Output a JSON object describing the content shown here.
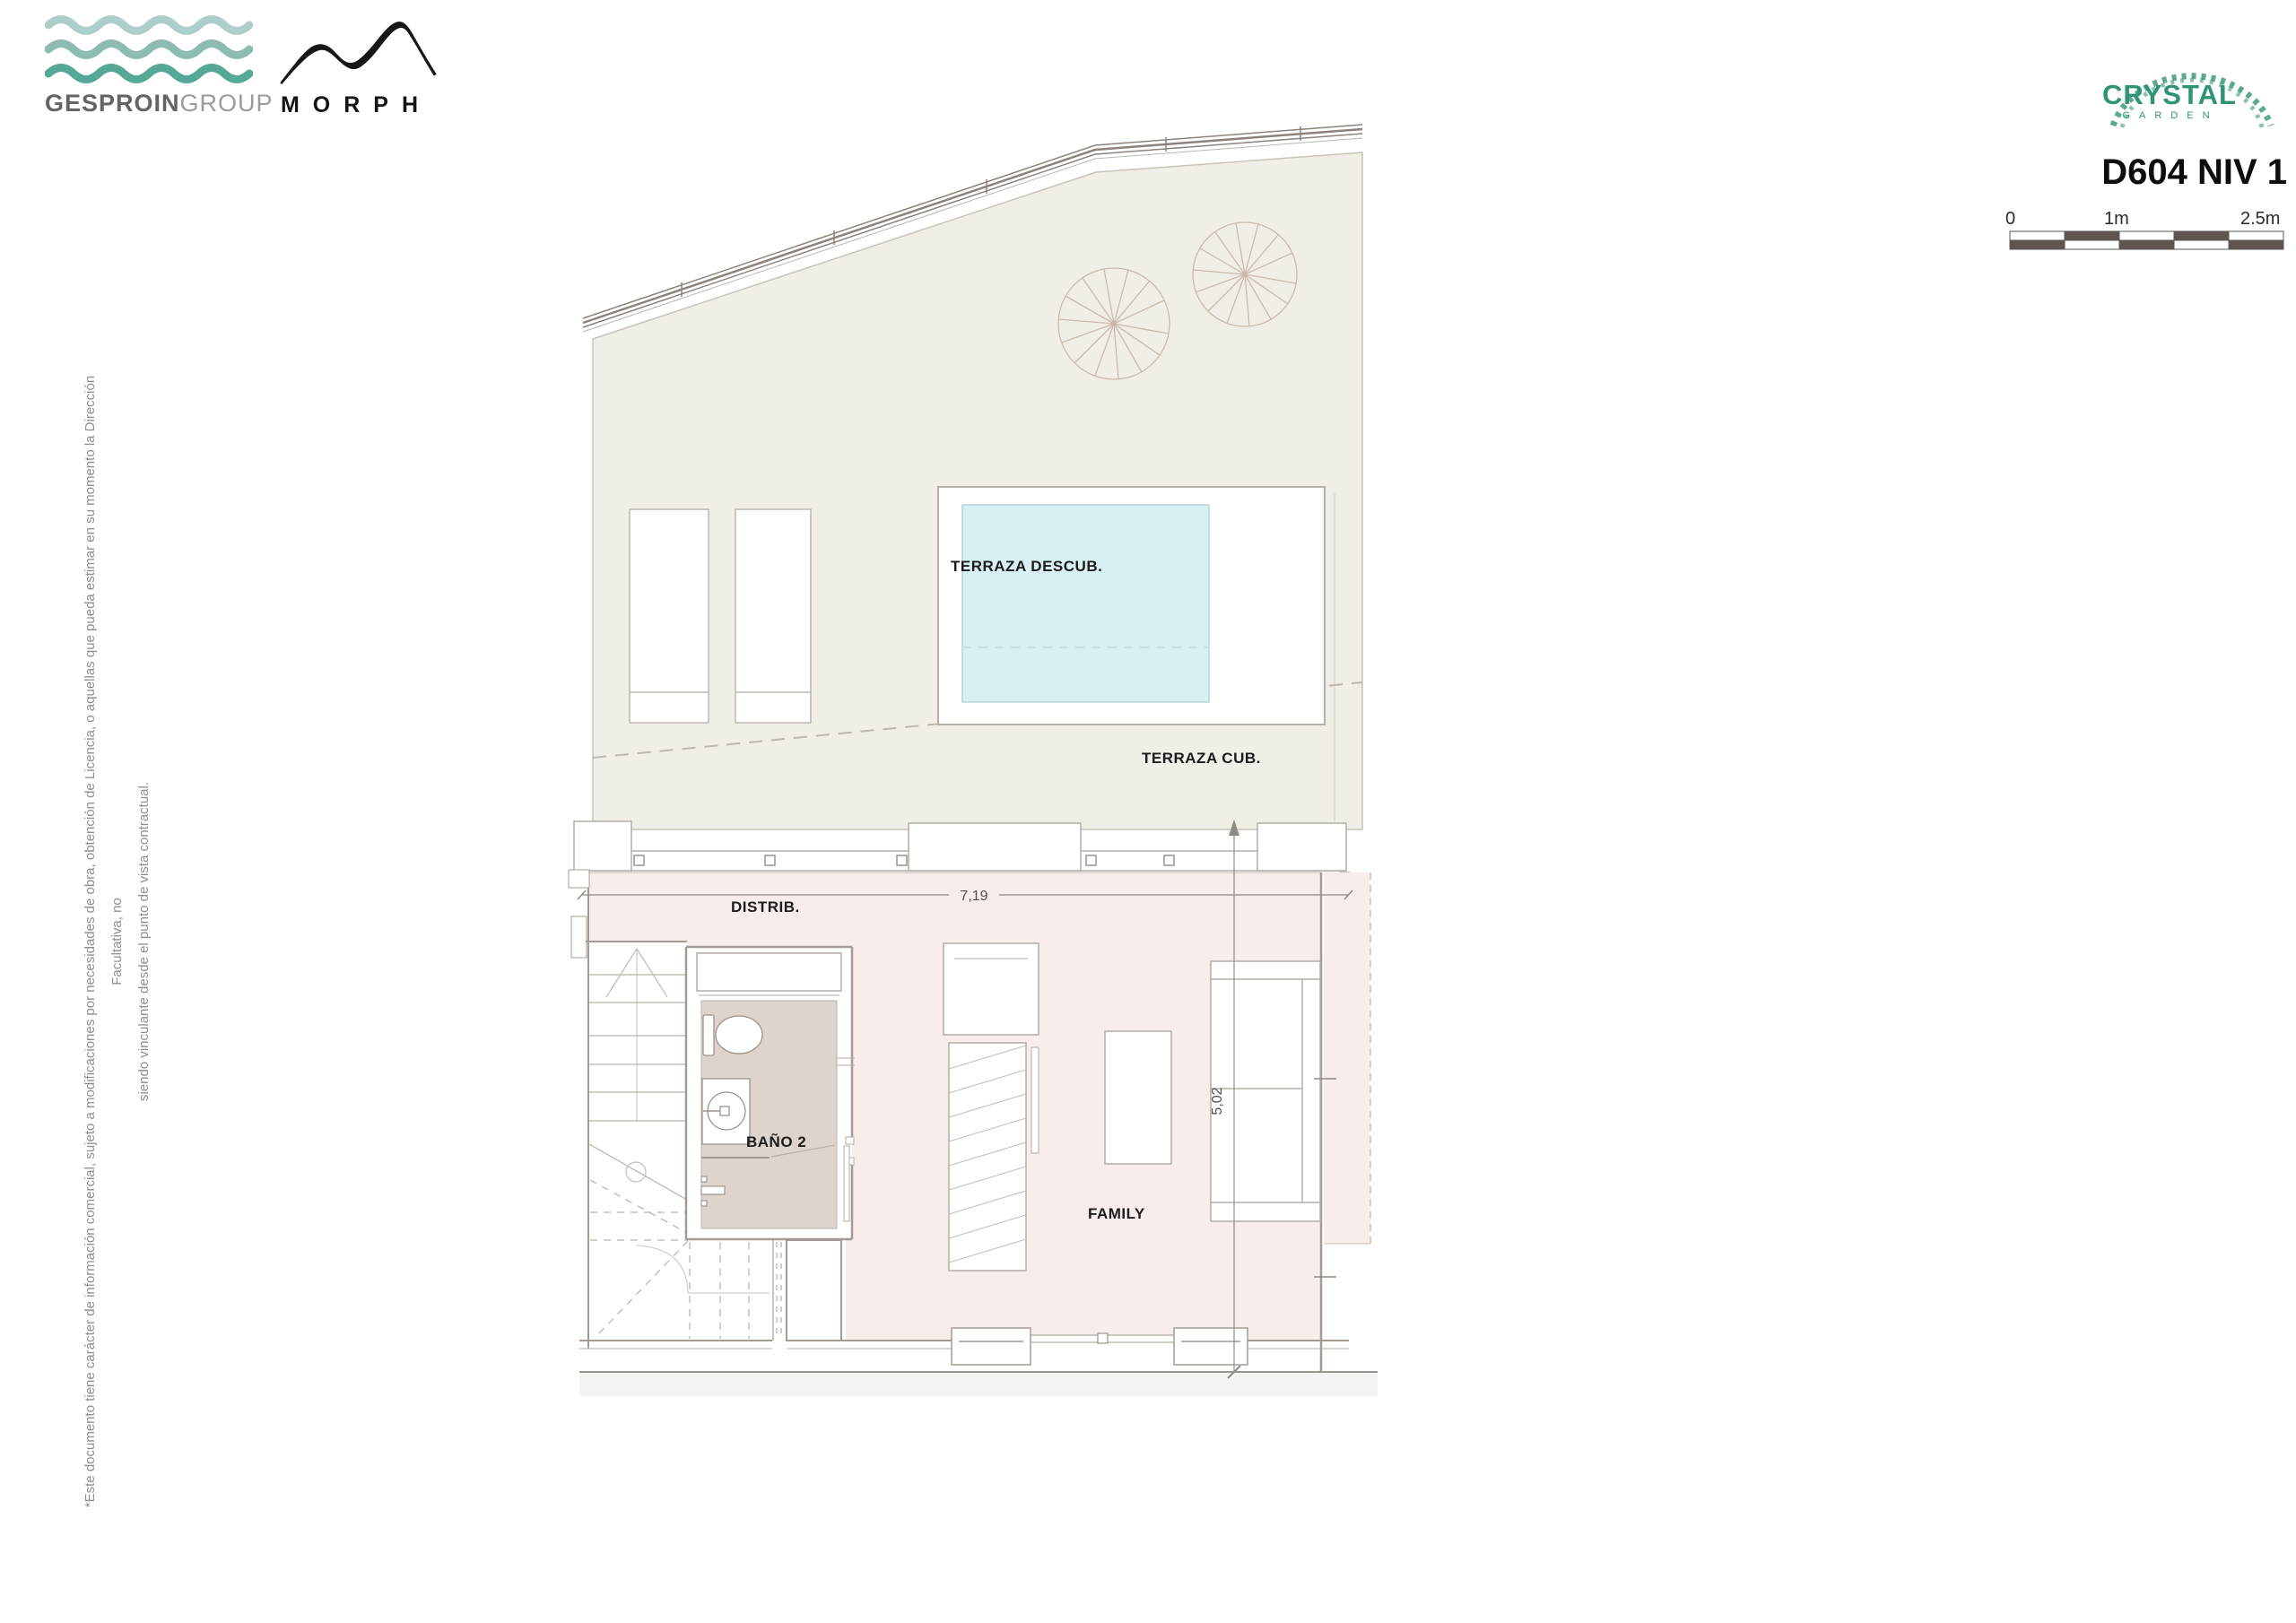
{
  "branding": {
    "gesproin": {
      "name_bold": "GESPROIN",
      "name_light": "GROUP"
    },
    "morph": {
      "name": "MORPH"
    },
    "crystal": {
      "line1": "CRYSTAL",
      "line2": "GARDEN"
    }
  },
  "header": {
    "title": "D604 NIV 1"
  },
  "scale_bar": {
    "labels": [
      "0",
      "1m",
      "2.5m"
    ]
  },
  "disclaimer": {
    "line1": "*Este documento tiene carácter de información comercial, sujeto a modificaciones por necesidades de obra, obtención de Licencia, o aquellas que pueda estimar en su momento la Dirección Facultativa, no",
    "line2": "siendo vinculante desde el punto de vista contractual."
  },
  "plan": {
    "rooms": {
      "terraza_descub": "TERRAZA DESCUB.",
      "terraza_cub": "TERRAZA CUB.",
      "distrib": "DISTRIB.",
      "bano2": "BAÑO 2",
      "family": "FAMILY"
    },
    "dimensions": {
      "width": "7,19",
      "height": "5,02"
    },
    "colors": {
      "terrace_cream": "#f0eee7",
      "interior_pink": "#f7edea",
      "pool_blue": "#d9f0f3",
      "bath_floor_gray": "#dcd4cd",
      "wall_gray": "#a49c94",
      "line_gray": "#b3ada5",
      "scale_dark": "#5e5450",
      "brand_green": "#2e9475",
      "wave_light": "#aecfc9",
      "wave_mid": "#8fbcb2",
      "wave_dark": "#55a796"
    }
  }
}
